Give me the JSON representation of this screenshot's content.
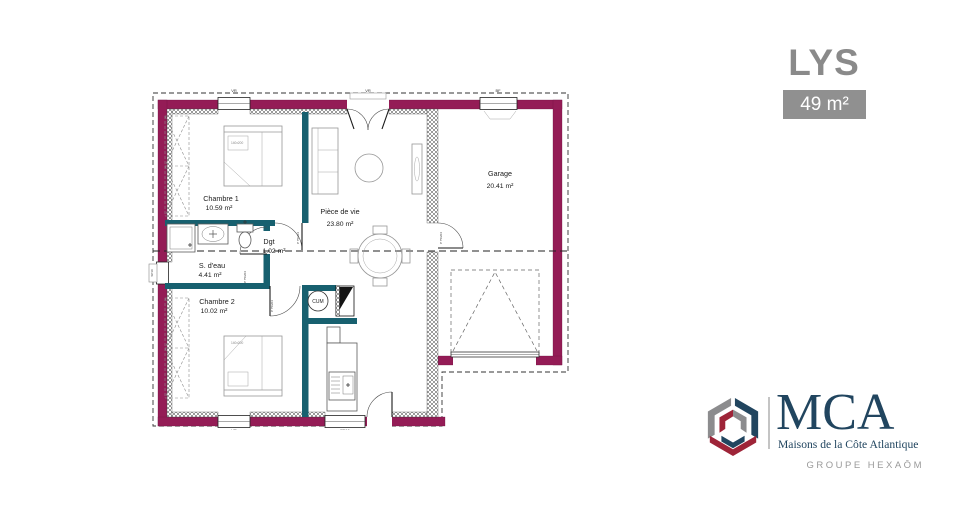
{
  "title": "LYS",
  "area_badge": "49 m²",
  "plan": {
    "rooms": {
      "chambre1": {
        "name": "Chambre 1",
        "area": "10.59 m²"
      },
      "piece_de_vie": {
        "name": "Pièce de vie",
        "area": "23.80 m²"
      },
      "garage": {
        "name": "Garage",
        "area": "20.41 m²"
      },
      "s_deau": {
        "name": "S. d'eau",
        "area": "4.41 m²"
      },
      "chambre2": {
        "name": "Chambre 2",
        "area": "10.02 m²"
      },
      "degagement": {
        "name": "Dgt",
        "area": "1.02 m²"
      }
    },
    "labels": {
      "water_heater": "CUM",
      "bed_size": "140x200",
      "door_tag": "P 75/204",
      "window_vr": "VR",
      "window_bf": "BF",
      "window_pf": "PF10",
      "side_opening": "SP10"
    },
    "colors": {
      "exterior_wall": "#941C56",
      "partition_wall": "#17606F"
    }
  },
  "branding": {
    "logo_text": "MCA",
    "logo_subtitle": "Maisons de la Côte Atlantique",
    "group_line": "GROUPE HEXAŌM",
    "colors": {
      "navy": "#21455f",
      "red": "#9e2438",
      "gray": "#8c8c8e"
    }
  },
  "ui_colors": {
    "title_gray": "#8a8a8a",
    "badge_bg": "#909090"
  }
}
